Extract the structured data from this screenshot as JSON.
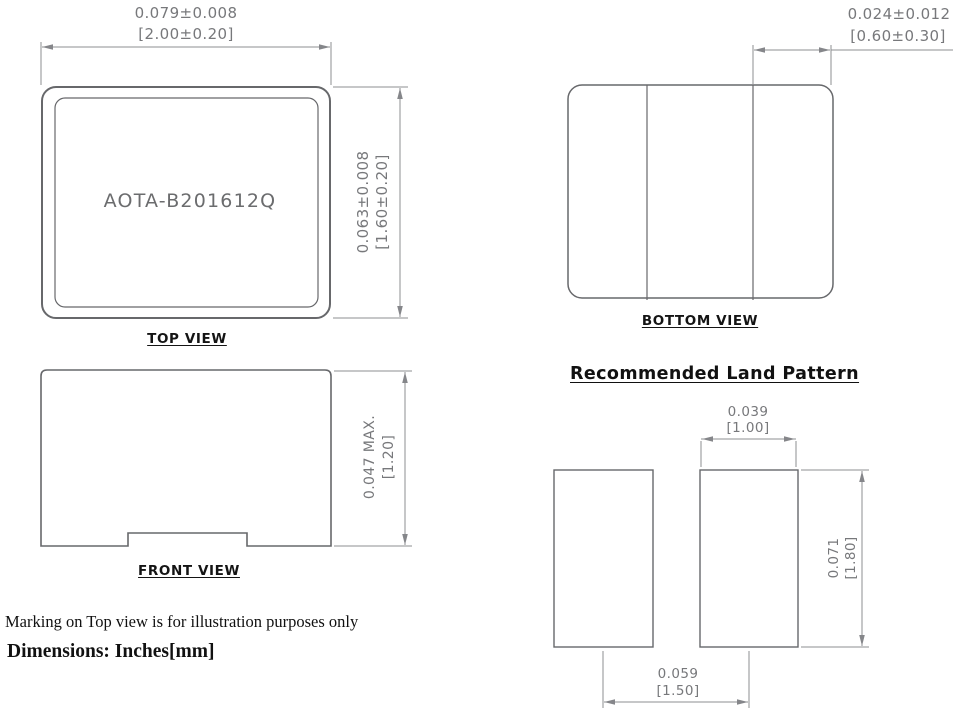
{
  "colors": {
    "outline": "#67686b",
    "dim_line": "#8e8f92",
    "dim_text": "#77787b",
    "label_text": "#141414"
  },
  "top_view": {
    "part_number": "AOTA-B201612Q",
    "label": "TOP VIEW",
    "width_dim_inch": "0.079±0.008",
    "width_dim_mm": "[2.00±0.20]",
    "height_dim_inch": "0.063±0.008",
    "height_dim_mm": "[1.60±0.20]"
  },
  "front_view": {
    "label": "FRONT VIEW",
    "height_dim_inch": "0.047 MAX.",
    "height_dim_mm": "[1.20]"
  },
  "bottom_view": {
    "label": "BOTTOM VIEW",
    "terminal_dim_inch": "0.024±0.012",
    "terminal_dim_mm": "[0.60±0.30]"
  },
  "land_pattern": {
    "title": "Recommended Land Pattern",
    "pad_width_inch": "0.039",
    "pad_width_mm": "[1.00]",
    "pad_height_inch": "0.071",
    "pad_height_mm": "[1.80]",
    "pad_pitch_inch": "0.059",
    "pad_pitch_mm": "[1.50]"
  },
  "notes": {
    "marking_note": "Marking on Top view is for illustration purposes only",
    "units_note": "Dimensions: Inches[mm]"
  }
}
